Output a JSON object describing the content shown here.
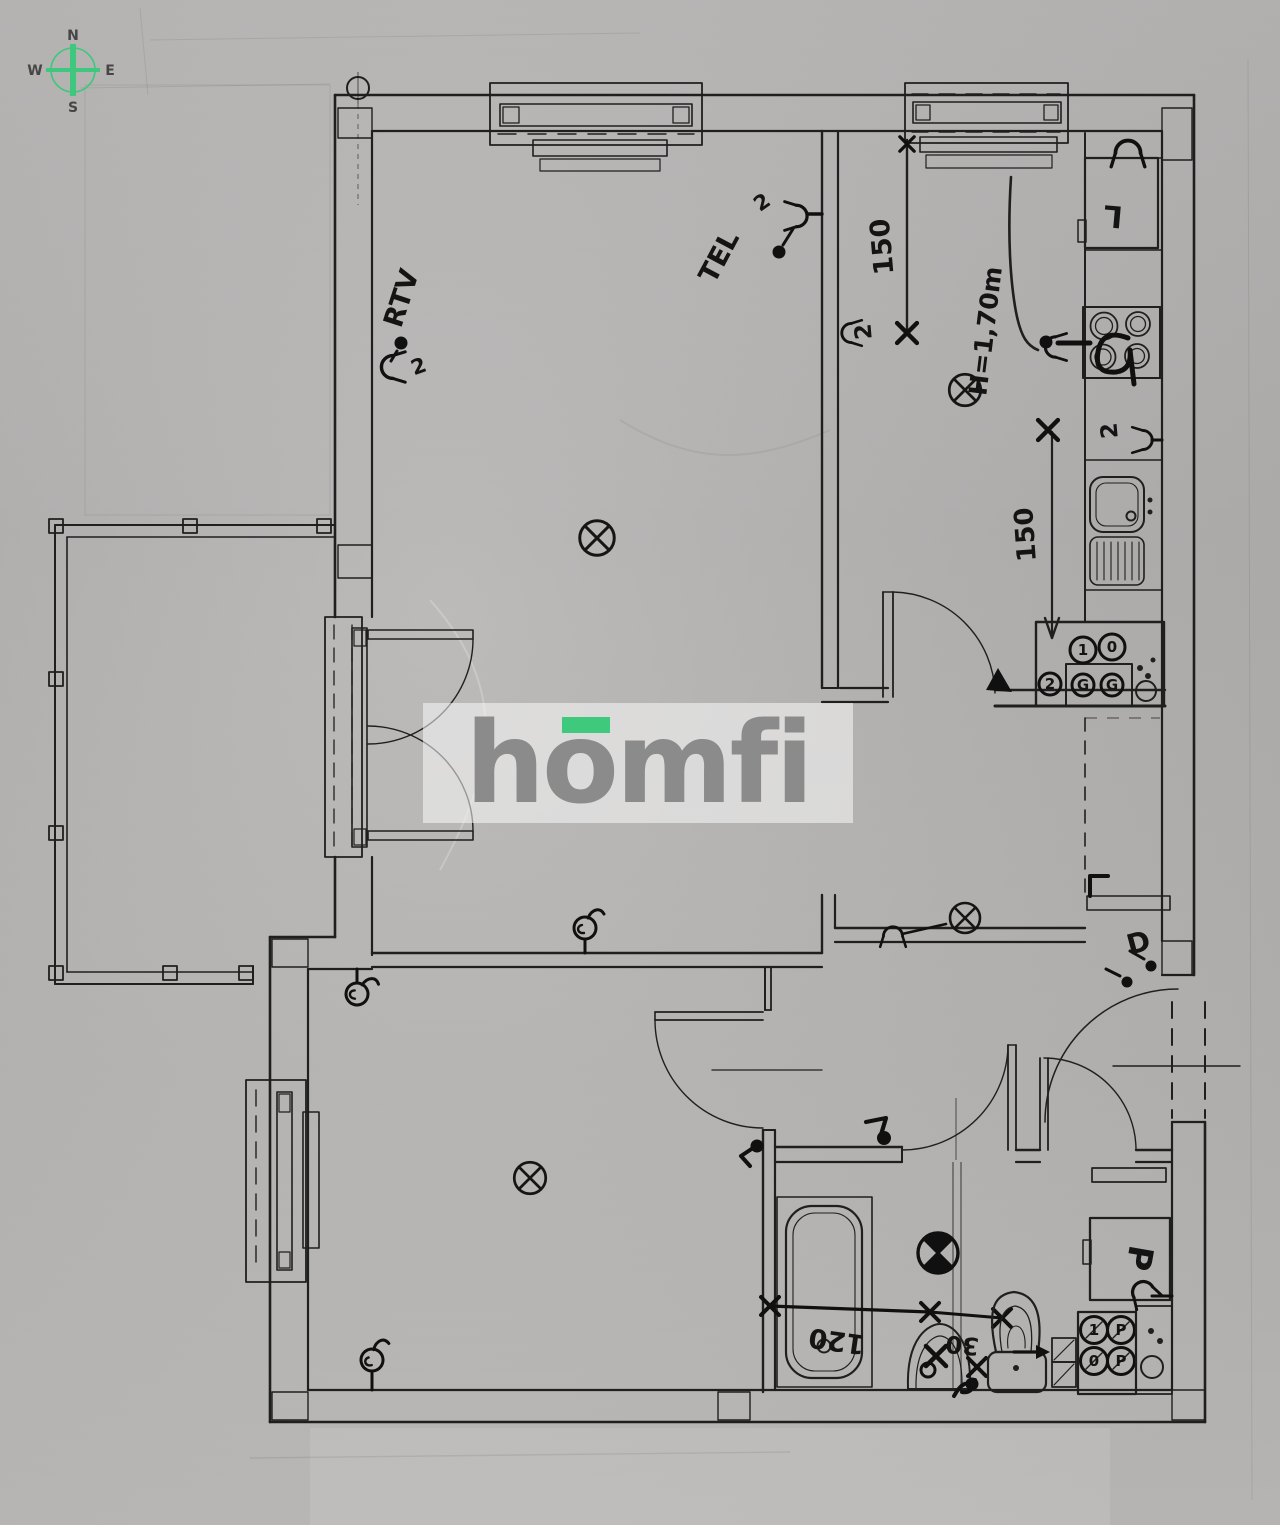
{
  "compass": {
    "north": "N",
    "east": "E",
    "south": "S",
    "west": "W"
  },
  "logo": {
    "brand": "homfi"
  },
  "annotations": {
    "rtv_label": "RTV",
    "tel_label": "TEL",
    "socket_double": "2",
    "window_dim": "150",
    "counter_dim": "150",
    "height_note": "H=1,70m",
    "fridge_label": "L",
    "entry_label": "D",
    "tub_dim": "120",
    "basin_dim": "30",
    "washer_label": "P",
    "kitchen_meters": [
      "1",
      "0",
      "2",
      "G",
      "G"
    ],
    "wc_meters": [
      "1",
      "P",
      "0",
      "P"
    ]
  },
  "colors": {
    "compass_green": "#3ec77d",
    "logo_green": "#3fc97c",
    "logo_gray": "#8b8b8b",
    "ink": "#1f1f1f",
    "paper": "#b7b5b3"
  }
}
